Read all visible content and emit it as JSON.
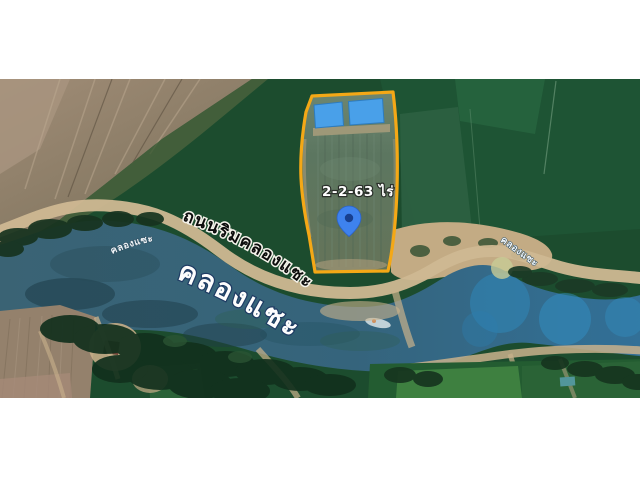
{
  "scene": {
    "type": "satellite-map-photo",
    "description": "aerial view of land plot beside canal"
  },
  "labels": {
    "area": "2-2-63 ไร่",
    "canal_large": "คลองแซะ",
    "road": "ถนนริมคลองแซะ",
    "canal_small_left": "คลองแซะ",
    "canal_small_right": "คลองแซะ"
  },
  "marker": {
    "name": "blue-map-pin",
    "color": "#3e82ee",
    "inner_color": "#173f8f"
  },
  "colors": {
    "letterbox": "#ffffff",
    "plot_outline": "#f4a816",
    "pond_fill": "#49a0e9",
    "water": "#3a6374",
    "field_dark_green": "#1c4c2e",
    "farmland_tan": "#998672",
    "road_sand": "#cfb892"
  }
}
